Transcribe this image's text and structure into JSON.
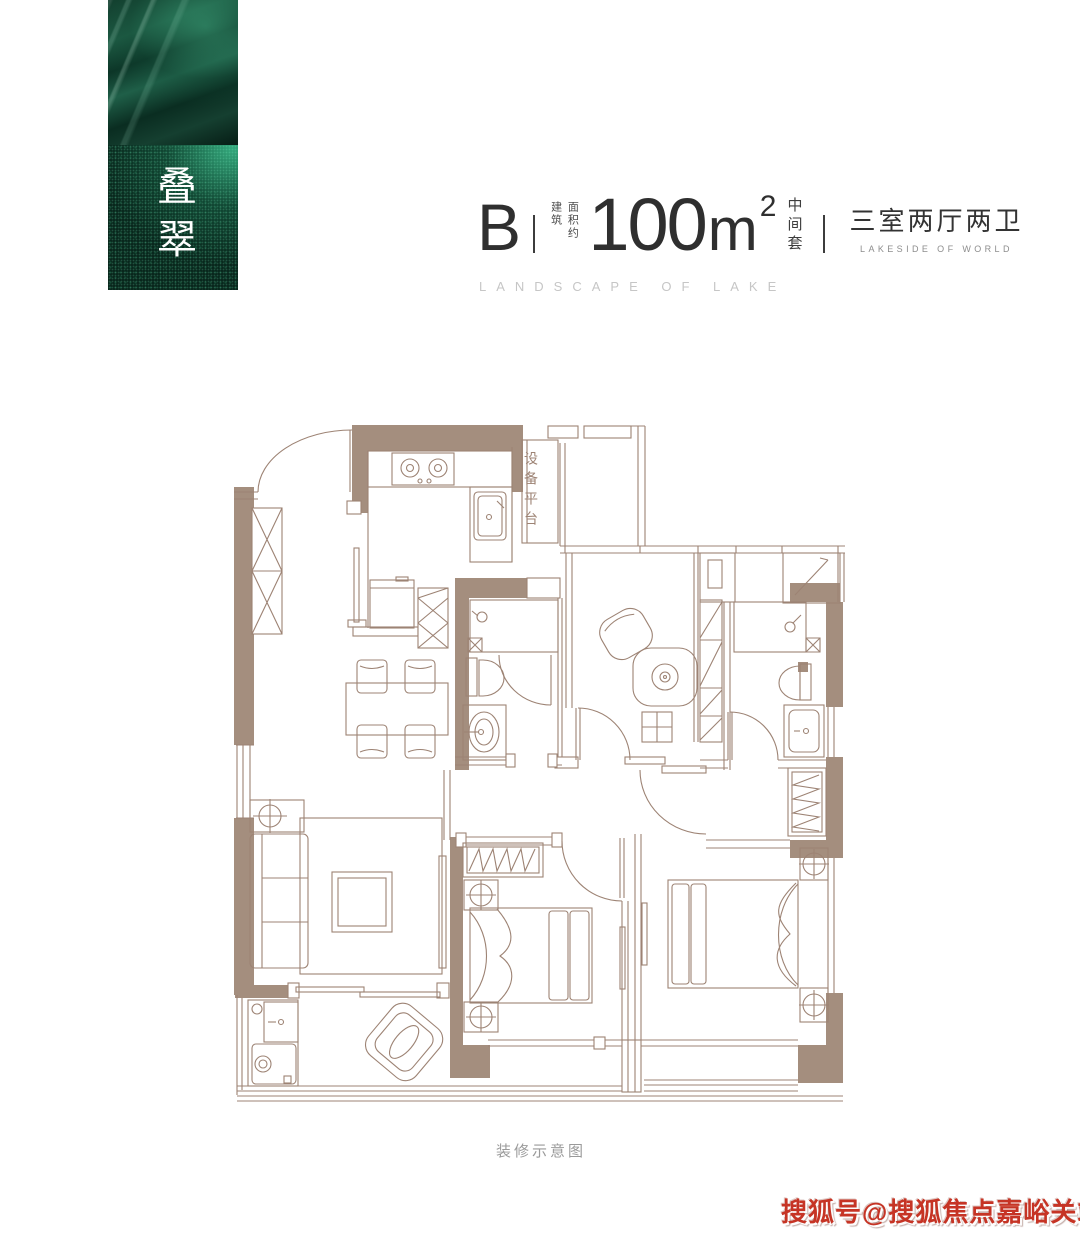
{
  "brand_card": {
    "name_vertical": "叠翠"
  },
  "title": {
    "unit_label": "B",
    "area_prefix_col1": "建筑",
    "area_prefix_col2": "面积约",
    "area_value": "100",
    "area_unit": "m",
    "area_exponent": "2",
    "position_label": "中间套",
    "layout_label": "三室两厅两卫",
    "layout_sublabel": "LAKESIDE OF WORLD",
    "tagline": "LANDSCAPE OF LAKE"
  },
  "floorplan": {
    "equipment_platform_label": "设备平台",
    "caption": "装修示意图",
    "colors": {
      "wall": "#a48e7e",
      "line": "#9d8374"
    }
  },
  "watermark": {
    "text": "搜狐号@搜狐焦点嘉峪关站",
    "color": "#c63425"
  }
}
